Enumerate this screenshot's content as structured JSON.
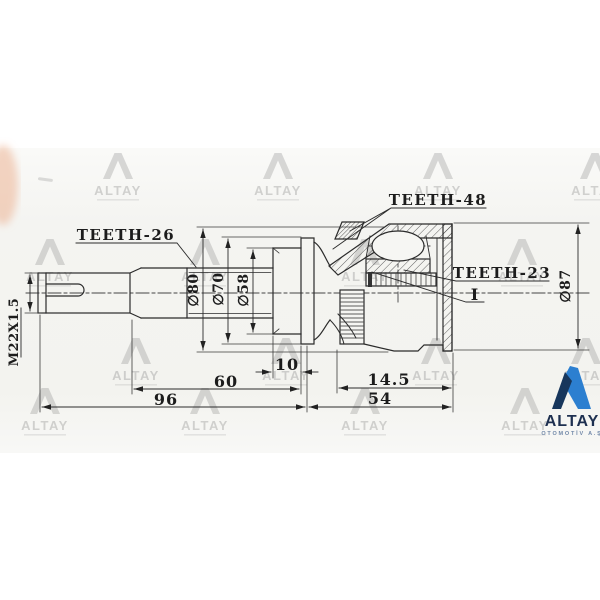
{
  "labels": {
    "teeth_48": "TEETH-48",
    "teeth_26": "TEETH-26",
    "teeth_23": "TEETH-23",
    "snap_ring": "I",
    "thread": "M22X1.5"
  },
  "diameters": {
    "d80": "∅80",
    "d70": "∅70",
    "d58": "∅58",
    "d87": "∅87"
  },
  "lengths": {
    "l10": "10",
    "l60": "60",
    "l96": "96",
    "l14_5": "14.5",
    "l54": "54"
  },
  "watermark": {
    "text": "ALTAY"
  },
  "logo": {
    "title": "ALTAY",
    "subtitle": "OTOMOTİV A.Ş",
    "colors": {
      "navy": "#17365c",
      "blue": "#2c7fd0",
      "text": "#1e3050"
    }
  }
}
